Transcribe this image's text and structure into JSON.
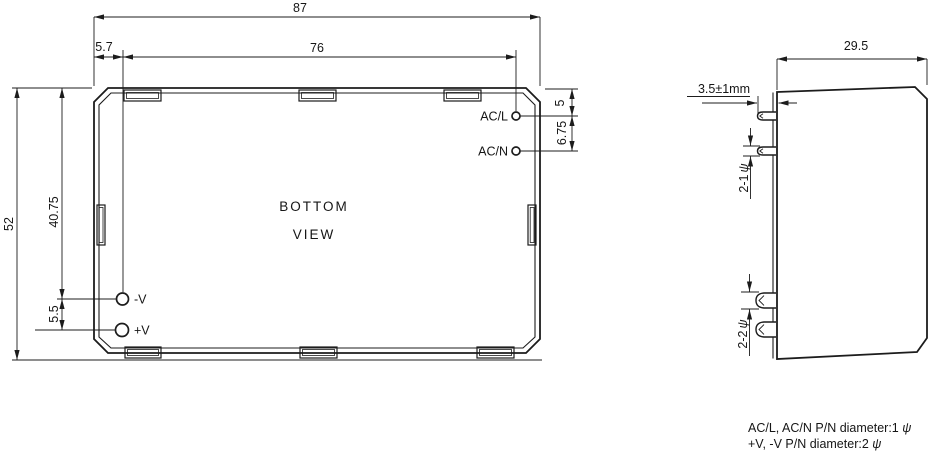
{
  "drawing": {
    "bottom_view": {
      "title_line1": "BOTTOM",
      "title_line2": "VIEW",
      "pins": {
        "acl": "AC/L",
        "acn": "AC/N",
        "neg": "-V",
        "pos": "+V"
      },
      "dims": {
        "overall_width": "87",
        "pin_span_width": "76",
        "pin_left_offset": "5.7",
        "overall_height": "52",
        "neg_pin_from_top": "40.75",
        "dc_pin_spacing": "5.5",
        "acl_from_top": "5",
        "ac_pin_spacing": "6.75"
      }
    },
    "side_view": {
      "dims": {
        "depth": "29.5",
        "pin_protrusion": "3.5±1mm",
        "ac_pin_count_dia": "2-1",
        "dc_pin_count_dia": "2-2",
        "dia_symbol": "ψ"
      }
    },
    "notes": {
      "line1_text": "AC/L, AC/N P/N diameter:1 ",
      "line2_text": "+V, -V P/N diameter:2 ",
      "dia_symbol": "ψ"
    }
  }
}
